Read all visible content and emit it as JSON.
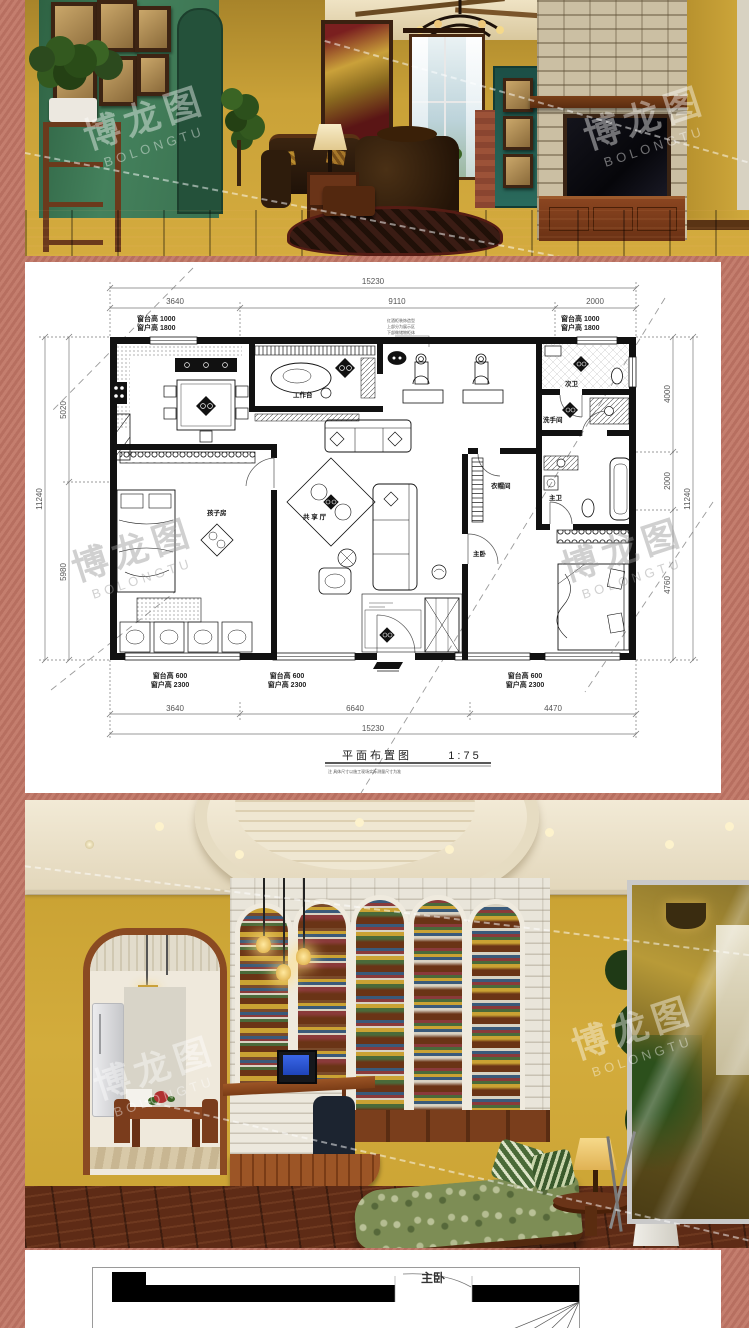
{
  "colors": {
    "border": "#c47e6e",
    "paper": "#ffffff",
    "plan_ink": "#111111",
    "green_wall": "#3e7a54",
    "yellow_wall": "#c9a135",
    "wood_floor": "#5e2b16",
    "white_brick": "#e9e5da"
  },
  "watermark": {
    "cn": "博龙图",
    "en": "BOLONGTU"
  },
  "floor_plan": {
    "title": "平面布置图",
    "scale": "1:75",
    "note": "注 具体尺寸以施工现场实际测量尺寸为准",
    "dims": {
      "top_total": "15230",
      "top_seg_1": "3640",
      "top_seg_2": "9110",
      "top_seg_3": "2000",
      "bottom_total": "15230",
      "bottom_seg_1": "3640",
      "bottom_seg_2": "6640",
      "bottom_seg_3": "4470",
      "left_total": "11240",
      "left_seg_1": "5020",
      "left_seg_2": "5980",
      "right_total": "11240",
      "right_seg_1": "4000",
      "right_seg_2": "2000",
      "right_seg_3": "4760"
    },
    "window_notes": {
      "top_left_1": "窗台高  1000",
      "top_left_2": "窗户高  1800",
      "top_right_1": "窗台高  1000",
      "top_right_2": "窗户高  1800",
      "bottom_1a": "窗台高  600",
      "bottom_1b": "窗户高  2300",
      "bottom_2a": "窗台高  600",
      "bottom_2b": "窗户高  2300",
      "bottom_3a": "窗台高  600",
      "bottom_3b": "窗户高  2300"
    },
    "rooms": {
      "kids": "孩子房",
      "hall": "共 享 厅",
      "master": "主卧",
      "closet": "衣帽间",
      "master_bath": "主卫",
      "wash": "洗手间",
      "second_bath": "次卫",
      "desk": "工作台"
    },
    "annotation": {
      "l1": "红酒柜装饰造型",
      "l2": "上部分为展示区",
      "l3": "下部做储物柜体"
    }
  },
  "bottom_drawing": {
    "room_label": "主卧"
  }
}
